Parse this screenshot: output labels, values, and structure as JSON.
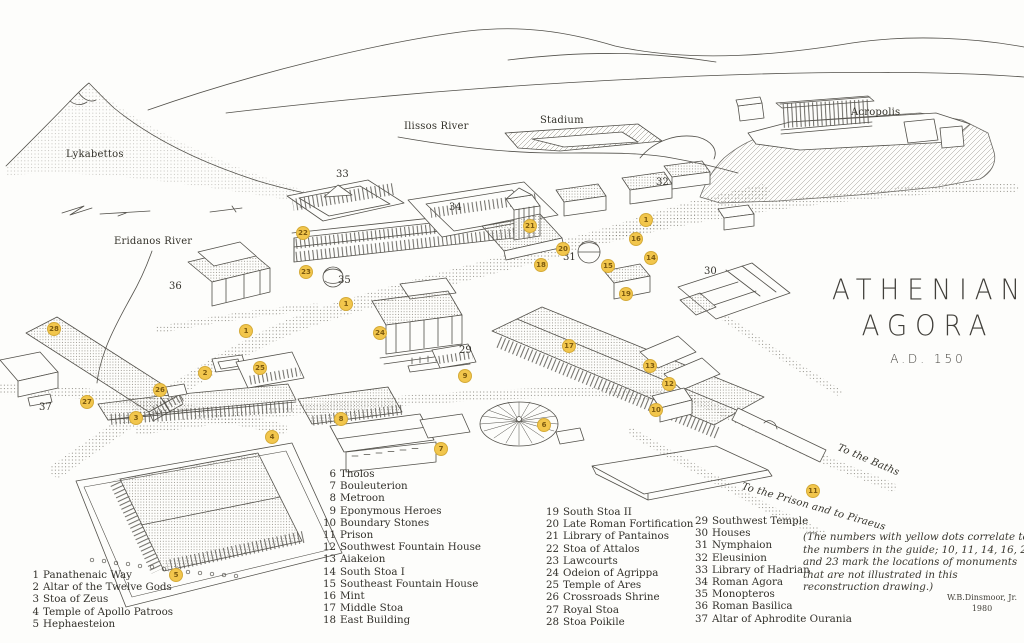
{
  "title": {
    "line1": "ATHENIAN",
    "line2": "AGORA",
    "date": "A.D. 150"
  },
  "map": {
    "labels": [
      {
        "id": "lykabettos",
        "text": "Lykabettos",
        "x": 66,
        "y": 149
      },
      {
        "id": "ilissos-river",
        "text": "Ilissos River",
        "x": 404,
        "y": 121
      },
      {
        "id": "stadium",
        "text": "Stadium",
        "x": 540,
        "y": 115
      },
      {
        "id": "acropolis",
        "text": "Acropolis",
        "x": 851,
        "y": 107
      },
      {
        "id": "eridanos-river",
        "text": "Eridanos River",
        "x": 114,
        "y": 236
      },
      {
        "id": "to-the-baths",
        "text": "To the Baths",
        "x": 838,
        "y": 442,
        "rotate": 23,
        "italic": true
      },
      {
        "id": "to-the-prison",
        "text": "To the Prison and to Piraeus",
        "x": 742,
        "y": 481,
        "rotate": 16,
        "italic": true
      }
    ],
    "plain_numbers": [
      {
        "n": "33",
        "x": 342,
        "y": 175
      },
      {
        "n": "34",
        "x": 455,
        "y": 208
      },
      {
        "n": "32",
        "x": 662,
        "y": 183
      },
      {
        "n": "30",
        "x": 710,
        "y": 272
      },
      {
        "n": "36",
        "x": 175,
        "y": 287
      },
      {
        "n": "35",
        "x": 344,
        "y": 281
      },
      {
        "n": "31",
        "x": 569,
        "y": 258
      },
      {
        "n": "29",
        "x": 465,
        "y": 351
      },
      {
        "n": "37",
        "x": 45,
        "y": 408
      }
    ],
    "markers": [
      {
        "n": "1",
        "x": 646,
        "y": 220
      },
      {
        "n": "16",
        "x": 636,
        "y": 239
      },
      {
        "n": "14",
        "x": 651,
        "y": 258
      },
      {
        "n": "21",
        "x": 530,
        "y": 226
      },
      {
        "n": "20",
        "x": 563,
        "y": 249
      },
      {
        "n": "18",
        "x": 541,
        "y": 265
      },
      {
        "n": "15",
        "x": 608,
        "y": 266
      },
      {
        "n": "19",
        "x": 626,
        "y": 294
      },
      {
        "n": "22",
        "x": 303,
        "y": 233
      },
      {
        "n": "23",
        "x": 306,
        "y": 272
      },
      {
        "n": "1",
        "x": 346,
        "y": 304
      },
      {
        "n": "1",
        "x": 246,
        "y": 331
      },
      {
        "n": "28",
        "x": 54,
        "y": 329
      },
      {
        "n": "25",
        "x": 260,
        "y": 368
      },
      {
        "n": "2",
        "x": 205,
        "y": 373
      },
      {
        "n": "26",
        "x": 160,
        "y": 390
      },
      {
        "n": "27",
        "x": 87,
        "y": 402
      },
      {
        "n": "3",
        "x": 136,
        "y": 418
      },
      {
        "n": "4",
        "x": 272,
        "y": 437
      },
      {
        "n": "24",
        "x": 380,
        "y": 333
      },
      {
        "n": "17",
        "x": 569,
        "y": 346
      },
      {
        "n": "13",
        "x": 650,
        "y": 366
      },
      {
        "n": "12",
        "x": 669,
        "y": 384
      },
      {
        "n": "9",
        "x": 465,
        "y": 376
      },
      {
        "n": "10",
        "x": 656,
        "y": 410
      },
      {
        "n": "8",
        "x": 341,
        "y": 419
      },
      {
        "n": "6",
        "x": 544,
        "y": 425
      },
      {
        "n": "7",
        "x": 441,
        "y": 449
      },
      {
        "n": "5",
        "x": 176,
        "y": 575
      },
      {
        "n": "11",
        "x": 813,
        "y": 491
      }
    ]
  },
  "legend": {
    "columns": [
      [
        {
          "n": "1",
          "label": "Panathenaic Way"
        },
        {
          "n": "2",
          "label": "Altar of the Twelve Gods"
        },
        {
          "n": "3",
          "label": "Stoa of Zeus"
        },
        {
          "n": "4",
          "label": "Temple of Apollo Patroos"
        },
        {
          "n": "5",
          "label": "Hephaesteion"
        }
      ],
      [
        {
          "n": "6",
          "label": "Tholos"
        },
        {
          "n": "7",
          "label": "Bouleuterion"
        },
        {
          "n": "8",
          "label": "Metroon"
        },
        {
          "n": "9",
          "label": "Eponymous Heroes"
        },
        {
          "n": "10",
          "label": "Boundary Stones"
        },
        {
          "n": "11",
          "label": "Prison"
        },
        {
          "n": "12",
          "label": "Southwest Fountain House"
        },
        {
          "n": "13",
          "label": "Aiakeion"
        },
        {
          "n": "14",
          "label": "South Stoa I"
        },
        {
          "n": "15",
          "label": "Southeast Fountain House"
        },
        {
          "n": "16",
          "label": "Mint"
        },
        {
          "n": "17",
          "label": "Middle Stoa"
        },
        {
          "n": "18",
          "label": "East Building"
        }
      ],
      [
        {
          "n": "19",
          "label": "South Stoa II"
        },
        {
          "n": "20",
          "label": "Late Roman Fortification"
        },
        {
          "n": "21",
          "label": "Library of Pantainos"
        },
        {
          "n": "22",
          "label": "Stoa of Attalos"
        },
        {
          "n": "23",
          "label": "Lawcourts"
        },
        {
          "n": "24",
          "label": "Odeion of Agrippa"
        },
        {
          "n": "25",
          "label": "Temple of Ares"
        },
        {
          "n": "26",
          "label": "Crossroads Shrine"
        },
        {
          "n": "27",
          "label": "Royal Stoa"
        },
        {
          "n": "28",
          "label": "Stoa Poikile"
        }
      ],
      [
        {
          "n": "29",
          "label": "Southwest Temple"
        },
        {
          "n": "30",
          "label": "Houses"
        },
        {
          "n": "31",
          "label": "Nymphaion"
        },
        {
          "n": "32",
          "label": "Eleusinion"
        },
        {
          "n": "33",
          "label": "Library of Hadrian"
        },
        {
          "n": "34",
          "label": "Roman Agora"
        },
        {
          "n": "35",
          "label": "Monopteros"
        },
        {
          "n": "36",
          "label": "Roman Basilica"
        },
        {
          "n": "37",
          "label": "Altar of Aphrodite Ourania"
        }
      ]
    ]
  },
  "note": "(The numbers with yellow dots correlate to the numbers in the guide; 10, 11, 14, 16, 20 and 23 mark the locations of monuments that are not illustrated in this reconstruction drawing.)",
  "credit": {
    "name": "W.B.Dinsmoor, Jr.",
    "year": "1980"
  },
  "colors": {
    "marker": "#f2c64c",
    "marker_text": "#7c5a10",
    "ink": "#52504a",
    "paper": "#fdfdfb"
  }
}
